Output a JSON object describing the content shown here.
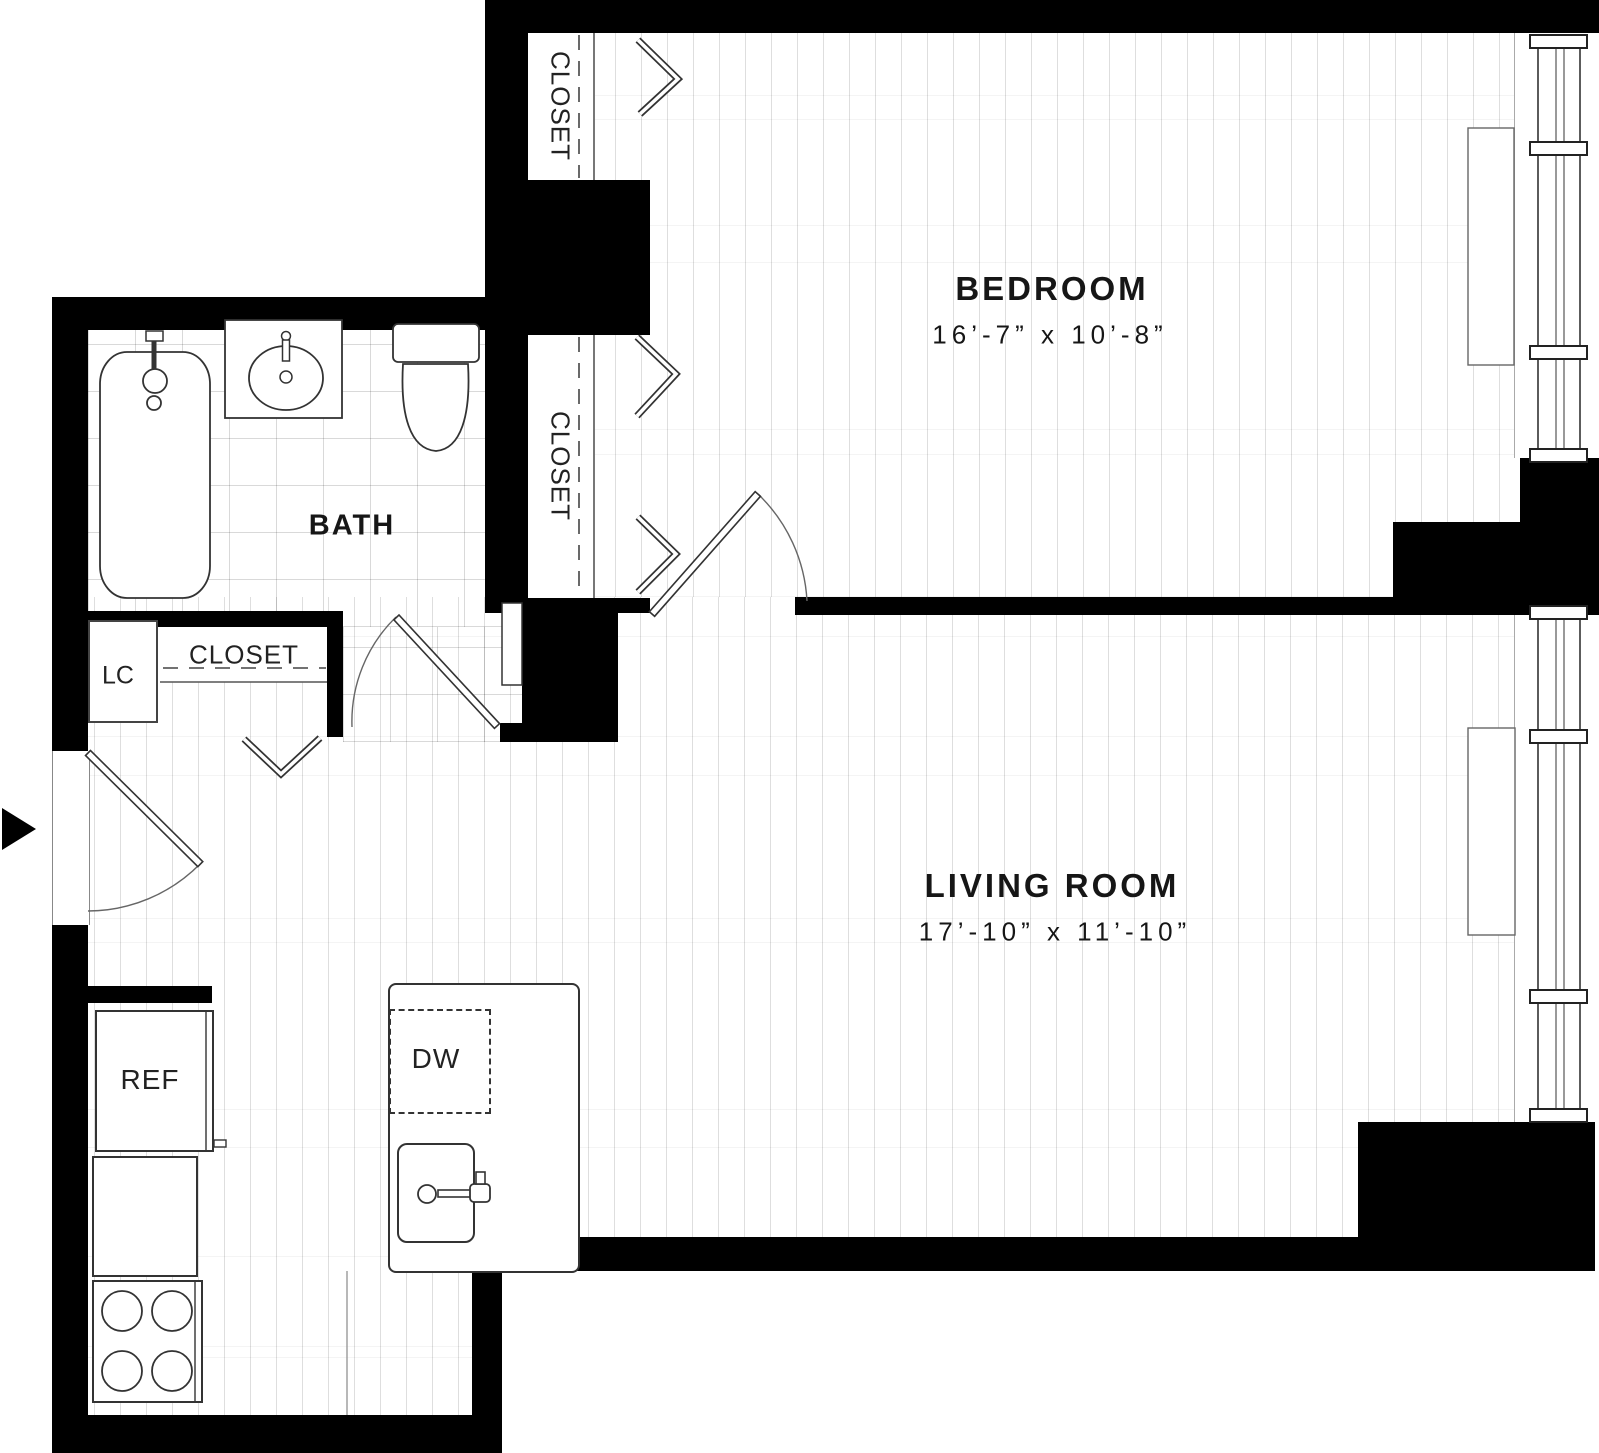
{
  "floor_plan": {
    "rooms": {
      "bedroom": {
        "name": "BEDROOM",
        "dimensions": "16’-7” x 10’-8”"
      },
      "living_room": {
        "name": "LIVING ROOM",
        "dimensions": "17’-10” x 11’-10”"
      },
      "bath": {
        "name": "BATH"
      },
      "bedroom_closet_upper": {
        "name": "CLOSET"
      },
      "bedroom_closet_lower": {
        "name": "CLOSET"
      },
      "entry_closet": {
        "name": "CLOSET"
      },
      "linen_cabinet": {
        "name": "LC"
      }
    },
    "appliances": {
      "refrigerator": "REF",
      "dishwasher": "DW"
    },
    "icons": {
      "entry_arrow": "entry-arrow",
      "bathtub": "bathtub-icon",
      "vanity_sink": "vanity-sink-icon",
      "toilet": "toilet-icon",
      "kitchen_sink": "kitchen-sink-icon",
      "stove": "stove-burners-icon",
      "windows": "window-mullions",
      "doors": "door-swing-arcs",
      "bifold_doors": "bifold-chevrons"
    },
    "colors": {
      "wall": "#000000",
      "fixture_line": "#333333",
      "plank_line": "#d9d9d9",
      "tile_line": "#cfcfcf",
      "background": "#ffffff"
    }
  }
}
